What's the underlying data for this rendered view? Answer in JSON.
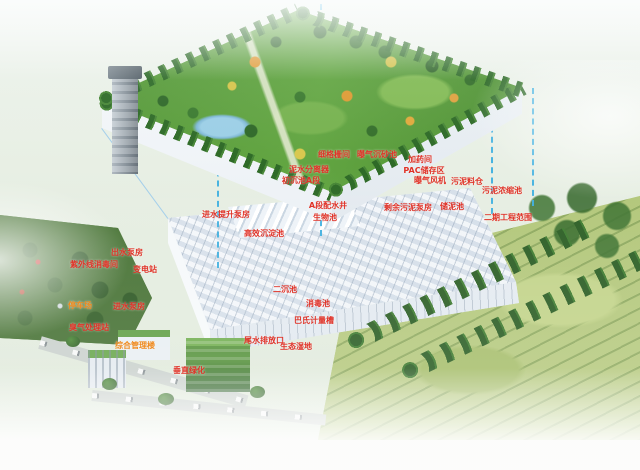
{
  "image": {
    "kind": "annotated-3d-rendering",
    "subject": "underground-wastewater-treatment-plant-with-rooftop-park"
  },
  "colors": {
    "label_red": "#e03227",
    "label_orange": "#ef8a1e",
    "line_blue": "#3fb0e0",
    "park_green": "#5a9c3c",
    "plant_white": "#e8edf3"
  },
  "labels": [
    {
      "text": "细格栅间",
      "x": 334,
      "y": 155,
      "color": "red"
    },
    {
      "text": "曝气沉砂池",
      "x": 377,
      "y": 155,
      "color": "red"
    },
    {
      "text": "加药间",
      "x": 420,
      "y": 160,
      "color": "red"
    },
    {
      "text": "PAC储存区",
      "x": 424,
      "y": 171,
      "color": "red"
    },
    {
      "text": "曝气风机",
      "x": 430,
      "y": 181,
      "color": "red"
    },
    {
      "text": "泥水分离器",
      "x": 309,
      "y": 170,
      "color": "red"
    },
    {
      "text": "初沉池A段",
      "x": 301,
      "y": 181,
      "color": "red"
    },
    {
      "text": "进水提升泵房",
      "x": 226,
      "y": 215,
      "color": "red"
    },
    {
      "text": "A段配水井",
      "x": 328,
      "y": 206,
      "color": "red"
    },
    {
      "text": "生物池",
      "x": 325,
      "y": 218,
      "color": "red"
    },
    {
      "text": "高效沉淀池",
      "x": 264,
      "y": 234,
      "color": "red"
    },
    {
      "text": "二沉池",
      "x": 285,
      "y": 290,
      "color": "red"
    },
    {
      "text": "消毒池",
      "x": 318,
      "y": 304,
      "color": "red"
    },
    {
      "text": "巴氏计量槽",
      "x": 314,
      "y": 321,
      "color": "red"
    },
    {
      "text": "尾水排放口",
      "x": 264,
      "y": 341,
      "color": "red"
    },
    {
      "text": "生态湿地",
      "x": 296,
      "y": 347,
      "color": "red"
    },
    {
      "text": "剩余污泥泵房",
      "x": 408,
      "y": 208,
      "color": "red"
    },
    {
      "text": "储泥池",
      "x": 452,
      "y": 207,
      "color": "red"
    },
    {
      "text": "污泥料仓",
      "x": 467,
      "y": 182,
      "color": "red"
    },
    {
      "text": "污泥浓缩池",
      "x": 502,
      "y": 191,
      "color": "red"
    },
    {
      "text": "二期工程范围",
      "x": 508,
      "y": 218,
      "color": "red"
    },
    {
      "text": "出水泵房",
      "x": 127,
      "y": 253,
      "color": "red"
    },
    {
      "text": "紫外线消毒间",
      "x": 94,
      "y": 265,
      "color": "red"
    },
    {
      "text": "变电站",
      "x": 145,
      "y": 270,
      "color": "red"
    },
    {
      "text": "停车场",
      "x": 80,
      "y": 306,
      "color": "orange"
    },
    {
      "text": "进水泵房",
      "x": 129,
      "y": 307,
      "color": "red"
    },
    {
      "text": "臭气处理站",
      "x": 89,
      "y": 328,
      "color": "red"
    },
    {
      "text": "综合管理楼",
      "x": 135,
      "y": 346,
      "color": "orange"
    },
    {
      "text": "垂直绿化",
      "x": 189,
      "y": 371,
      "color": "red"
    }
  ]
}
